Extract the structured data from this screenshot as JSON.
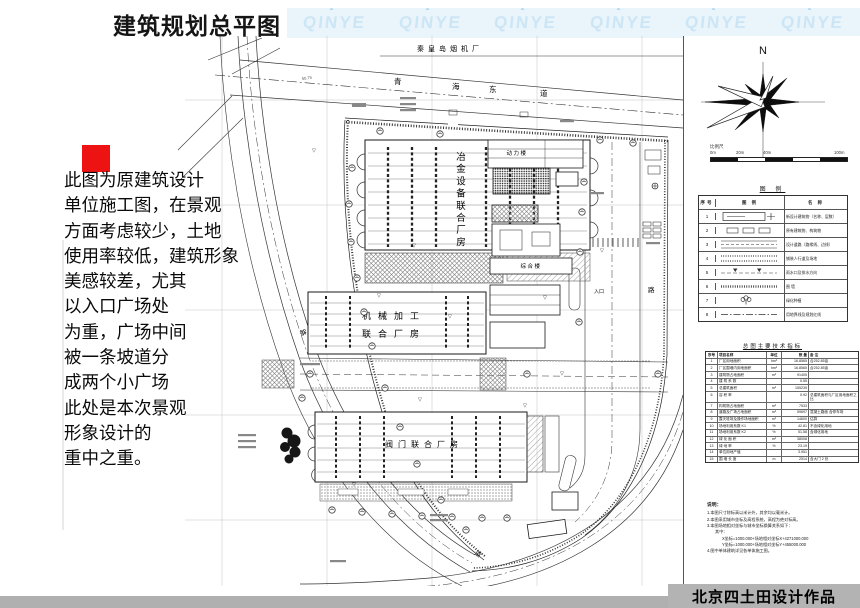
{
  "header": {
    "title": "建筑规划总平图",
    "watermark": "QINYE",
    "watermark_count": 6,
    "band_color": "#e9f4fb",
    "logo_color": "#cde6f6"
  },
  "annotation": {
    "marker_color": "#ee1313",
    "lines": [
      "此图为原建筑设计",
      "单位施工图，在景观",
      "方面考虑较少，土地",
      "使用率较低，建筑形象",
      "美感较差，尤其",
      "以入口广场处",
      "为重，广场中间",
      "被一条坡道分",
      "成两个小广场",
      "此处是本次景观",
      "形象设计的",
      "重中之重。"
    ]
  },
  "plan": {
    "north_site_label": "秦皇岛烟机厂",
    "road_north": {
      "name": "青海东道",
      "chars": [
        "青",
        "海",
        "东",
        "道"
      ]
    },
    "road_side_label": "路",
    "road_bottom_label": "道",
    "dim_label": "50.75",
    "entrance_label": "入口",
    "benchmark_glyph": "▽",
    "buildings": {
      "b1": {
        "name": "冶金设备联合厂房",
        "chars": [
          "冶",
          "金",
          "设",
          "备",
          "联",
          "合",
          "厂",
          "房"
        ]
      },
      "b2": {
        "name": "机械加工联合厂房",
        "line1": "机械加工",
        "line2": "联合厂房"
      },
      "b3": {
        "name": "阀门联合厂房"
      },
      "b4": {
        "name": "动力楼"
      },
      "b5": {
        "name": "综合楼"
      }
    }
  },
  "panel": {
    "compass_label": "N",
    "scale": {
      "label": "比例尺",
      "ticks": [
        "0m",
        "20m",
        "40m",
        "100m"
      ]
    },
    "legend": {
      "title": "图 例",
      "col_no": "序号",
      "col_symbol": "图 例",
      "col_name": "名 称",
      "rows": [
        {
          "no": "1",
          "name": "新设计建筑物（名称、层数）"
        },
        {
          "no": "2",
          "name": "原有建筑物、构筑物"
        },
        {
          "no": "3",
          "name": "设计道路（路缘线、边线）"
        },
        {
          "no": "4",
          "name": "铺装人行道及场地"
        },
        {
          "no": "5",
          "name": "雨水口及排水方向"
        },
        {
          "no": "6",
          "name": "围 墙"
        },
        {
          "no": "7",
          "name": "绿化种植"
        },
        {
          "no": "8",
          "name": "用地界线及规划红线"
        }
      ]
    },
    "indicators": {
      "title": "总图主要技术指标",
      "headers": [
        "序号",
        "项目名称",
        "单位",
        "数 量",
        "备 注"
      ],
      "rows": [
        [
          "1",
          "厂区用地面积",
          "hm²",
          "16.8565",
          "合252.85亩"
        ],
        [
          "2",
          "厂区围墙内用地面积",
          "hm²",
          "16.8565",
          "合252.85亩"
        ],
        [
          "3",
          "建筑物占地面积",
          "m²",
          "91405",
          ""
        ],
        [
          "4",
          "建 筑 系 数",
          "",
          "0.55",
          ""
        ],
        [
          "5",
          "总建筑面积",
          "m²",
          "155239",
          ""
        ],
        [
          "6",
          "容 积 率",
          "",
          "0.92",
          "总建筑面积与厂区用地面积之比"
        ],
        [
          "7",
          "构筑物占地面积",
          "m²",
          "7533",
          ""
        ],
        [
          "8",
          "道路及广场占地面积",
          "m²",
          "59697",
          "混凝土路面 含停车场"
        ],
        [
          "9",
          "露天堆场及操作场地面积",
          "m²",
          "14600",
          "估算"
        ],
        [
          "10",
          "场地利用系数 K1",
          "%",
          "42.81",
          "不含绿化用地"
        ],
        [
          "11",
          "场地利用系数 K2",
          "%",
          "51.58",
          "含绿化用地"
        ],
        [
          "12",
          "绿 化 面 积",
          "m²",
          "38008",
          ""
        ],
        [
          "13",
          "绿 地 率",
          "%",
          "23.19",
          ""
        ],
        [
          "14",
          "单位用地产值",
          "",
          "3.951",
          ""
        ],
        [
          "15",
          "围 墙 长 度",
          "m",
          "2514",
          "含大门 2 处"
        ]
      ]
    },
    "notes": {
      "title": "说明：",
      "lines": [
        "1.本图尺寸除标高以米计外，其余均以毫米计。",
        "2.本图采用城市坐标及高程系统，高程为绝对标高。",
        "3.本图场地相对坐标与城市坐标换算关系如下：",
        "其中：",
        "X坐标=1000.000+场地相对坐标X+4271000.000",
        "Y坐标=1000.000+场地相对坐标Y+455000.000",
        "4.图中单体建筑详见各单体施工图。"
      ]
    }
  },
  "footer": {
    "credit": "北京四土田设计作品"
  }
}
